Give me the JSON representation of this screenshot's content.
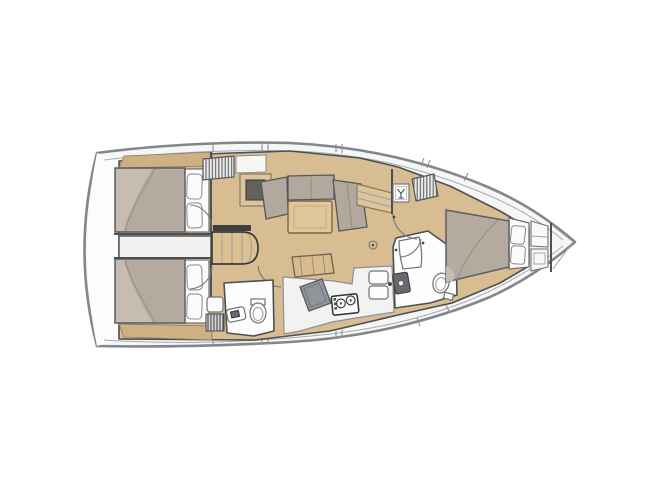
{
  "page": {
    "background": "#ffffff"
  },
  "colors": {
    "bg": "#ffffff",
    "hull_outline": "#82878c",
    "wall": "#4d4f52",
    "floor": "#d8bd92",
    "floor_trim": "#cdb183",
    "step": "#ddc193",
    "mattress": "#b5aa9f",
    "mattress_fold": "#c6bcb1",
    "pillow": "#fbfbfa",
    "cushion": "#b2a89d",
    "table": "#e0c69c",
    "counter": "#f2f2f1",
    "engine_box": "#f1f1f0",
    "sideboard_frame": "#dcc49c",
    "sideboard_inset": "#63615c",
    "chart_table": "#8f959b",
    "stove_line": "#2e3031",
    "fixture_dark": "#676b6f",
    "hatch_line": "#55575a"
  },
  "plan": {
    "type": "sailing-yacht-interior-floor-plan",
    "orientation": "bow-right",
    "rooms": [
      "aft-cabin-port",
      "aft-cabin-starboard",
      "engine-compartment",
      "companionway",
      "salon",
      "aft-head",
      "galley",
      "forward-head",
      "forward-cabin",
      "bow-locker"
    ],
    "fixtures": [
      "double-berth-port",
      "double-berth-starboard",
      "island-berth-forward",
      "pillows",
      "u-settee",
      "saloon-table",
      "sideboard-tv",
      "nav-seat",
      "chart-table",
      "two-burner-stove",
      "double-sink",
      "toilet",
      "washbasin",
      "shower",
      "hanging-locker-louvered",
      "glass-locker",
      "companionway-steps",
      "shower-grate"
    ]
  }
}
